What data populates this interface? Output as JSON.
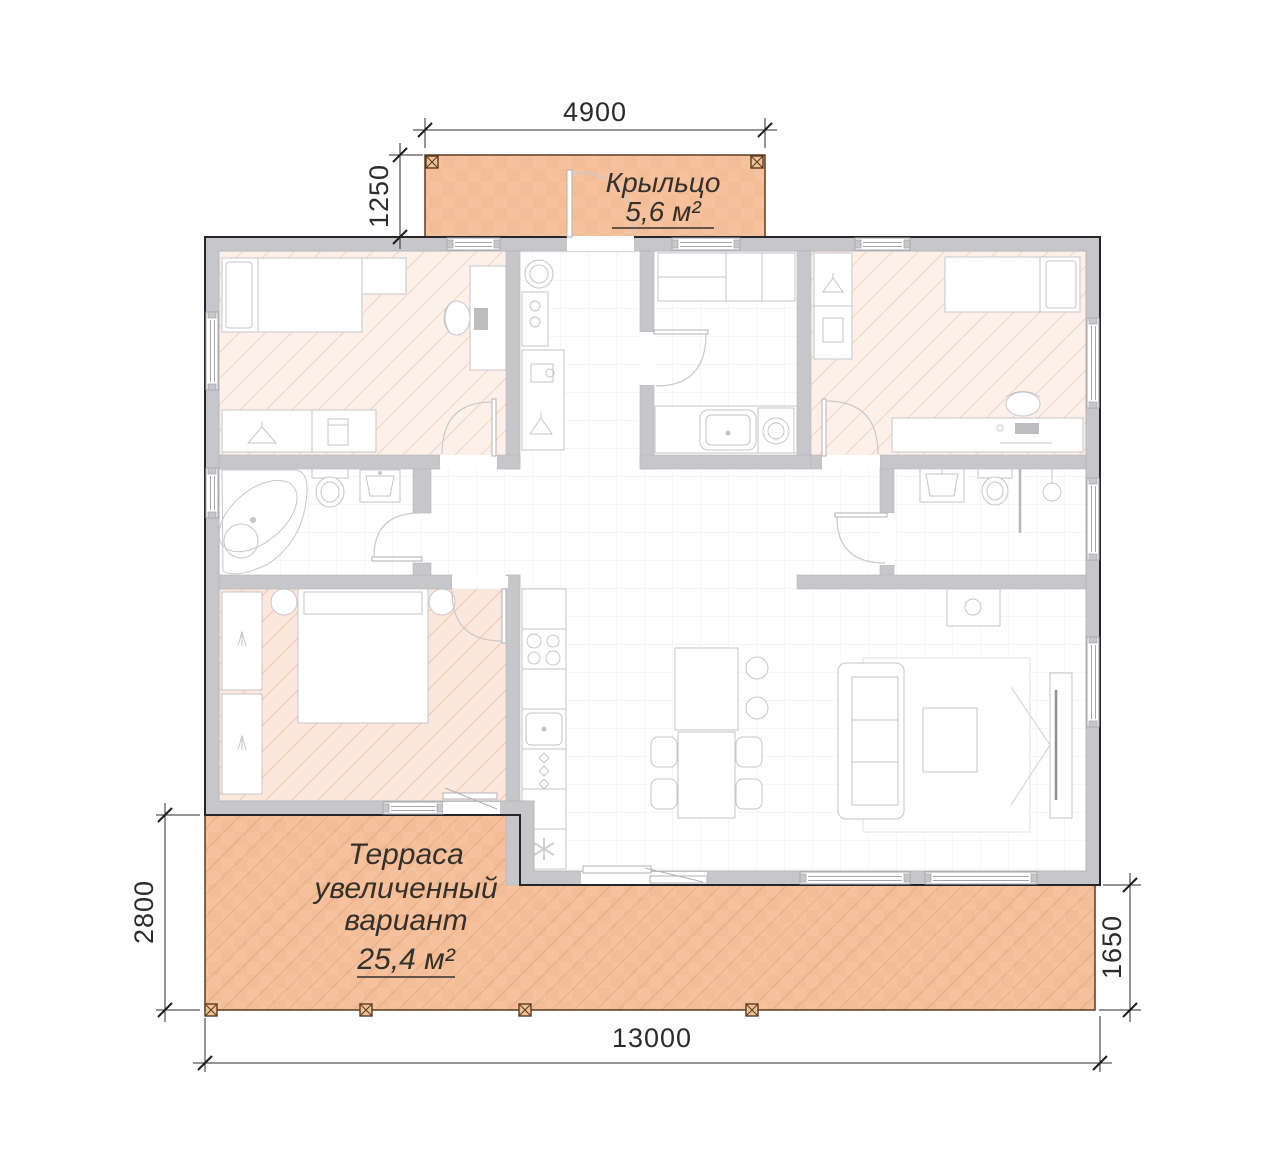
{
  "drawing": {
    "type": "house floor plan",
    "labels": {
      "porch": {
        "title": "Крыльцо",
        "area": "5,6 м²"
      },
      "terrace": {
        "line1": "Терраса",
        "line2": "увеличенный",
        "line3": "вариант",
        "area": "25,4 м²"
      }
    },
    "dimensions": {
      "porch_width": "4900",
      "porch_depth": "1250",
      "terrace_depth_left": "2800",
      "terrace_depth_right": "1650",
      "house_width": "13000"
    },
    "colors": {
      "deck_fill": "#f6c29e",
      "deck_outline": "#5a3b20",
      "wall_fill": "#c7c7cb",
      "outer_outline": "#26262a",
      "bedroom_floor": "#fdf0e9",
      "bedroom_hatch": "#f3dacd",
      "master_floor": "#fbe7dc",
      "master_hatch": "#eecfc0",
      "dimension_color": "#2b2b2b"
    }
  }
}
